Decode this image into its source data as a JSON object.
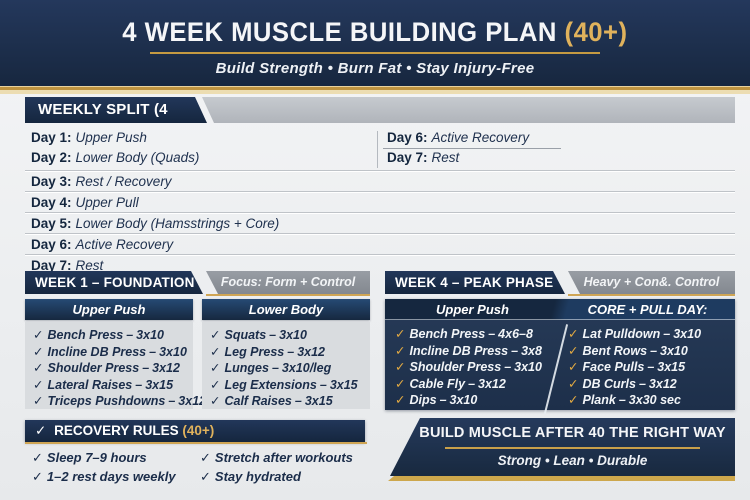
{
  "colors": {
    "navy": "#17273f",
    "panel_navy": "#223650",
    "gold": "#bf9440",
    "gold_text": "#e0b25c",
    "gray_bar": "#b6bac0",
    "focus_gray": "#8d9299",
    "list_gray": "#d9dcdf",
    "text_navy": "#1b2d4a"
  },
  "misc": {
    "check": "✓",
    "dash": "–"
  },
  "header": {
    "title": "4 WEEK MUSCLE BUILDING PLAN",
    "title_suffix": "(40+)",
    "subtitle": "Build Strength • Burn Fat • Stay Injury-Free"
  },
  "weekly_split": {
    "title": "WEEKLY SPLIT (4 DAYS)",
    "left_days": [
      {
        "label": "Day 1:",
        "value": "Upper Push"
      },
      {
        "label": "Day 2:",
        "value": "Lower Body (Quads)"
      }
    ],
    "right_days": [
      {
        "label": "Day 6:",
        "value": "Active Recovery"
      },
      {
        "label": "Day 7:",
        "value": "Rest"
      }
    ],
    "full_days": [
      {
        "label": "Day 3:",
        "value": "Rest / Recovery"
      },
      {
        "label": "Day 4:",
        "value": "Upper Pull"
      },
      {
        "label": "Day 5:",
        "value": "Lower Body (Hamsstrings + Core)"
      },
      {
        "label": "Day 6:",
        "value": "Active Recovery"
      },
      {
        "label": "Day 7:",
        "value": "Rest"
      }
    ]
  },
  "week1": {
    "title": "WEEK 1 – FOUNDATION",
    "focus": "Focus: Form + Control",
    "columns": [
      {
        "header": "Upper Push",
        "items": [
          {
            "name": "Bench Press",
            "reps": "3x10"
          },
          {
            "name": "Incline DB Press",
            "reps": "3x10"
          },
          {
            "name": "Shoulder Press",
            "reps": "3x12"
          },
          {
            "name": "Lateral Raises",
            "reps": "3x15"
          },
          {
            "name": "Triceps Pushdowns",
            "reps": "3x12"
          }
        ]
      },
      {
        "header": "Lower Body",
        "items": [
          {
            "name": "Squats",
            "reps": "3x10"
          },
          {
            "name": "Leg Press",
            "reps": "3x12"
          },
          {
            "name": "Lunges",
            "reps": "3x10/leg"
          },
          {
            "name": "Leg Extensions",
            "reps": "3x15"
          },
          {
            "name": "Calf Raises",
            "reps": "3x15"
          }
        ]
      }
    ]
  },
  "week4": {
    "title": "WEEK 4 – PEAK PHASE",
    "focus": "Heavy + Con&. Control",
    "columns": [
      {
        "header": "Upper Push",
        "items": [
          {
            "name": "Bench Press",
            "reps": "4x6–8"
          },
          {
            "name": "Incline DB Press",
            "reps": "3x8"
          },
          {
            "name": "Shoulder Press",
            "reps": "3x10"
          },
          {
            "name": "Cable Fly",
            "reps": "3x12"
          },
          {
            "name": "Dips",
            "reps": "3x10"
          }
        ]
      },
      {
        "header": "CORE + PULL DAY:",
        "items": [
          {
            "name": "Lat Pulldown",
            "reps": "3x10"
          },
          {
            "name": "Bent Rows",
            "reps": "3x10"
          },
          {
            "name": "Face Pulls",
            "reps": "3x15"
          },
          {
            "name": "DB Curls",
            "reps": "3x12"
          },
          {
            "name": "Plank",
            "reps": "3x30 sec"
          }
        ]
      }
    ]
  },
  "recovery": {
    "title": "RECOVERY RULES",
    "title_suffix": "(40+)",
    "col1": [
      {
        "text": "Sleep 7–9 hours"
      },
      {
        "text": "1–2 rest days weekly"
      }
    ],
    "col2": [
      {
        "text": "Stretch after workouts"
      },
      {
        "text": "Stay hydrated"
      }
    ]
  },
  "footer": {
    "title": "BUILD MUSCLE AFTER 40 THE RIGHT WAY",
    "subtitle": "Strong • Lean • Durable"
  }
}
